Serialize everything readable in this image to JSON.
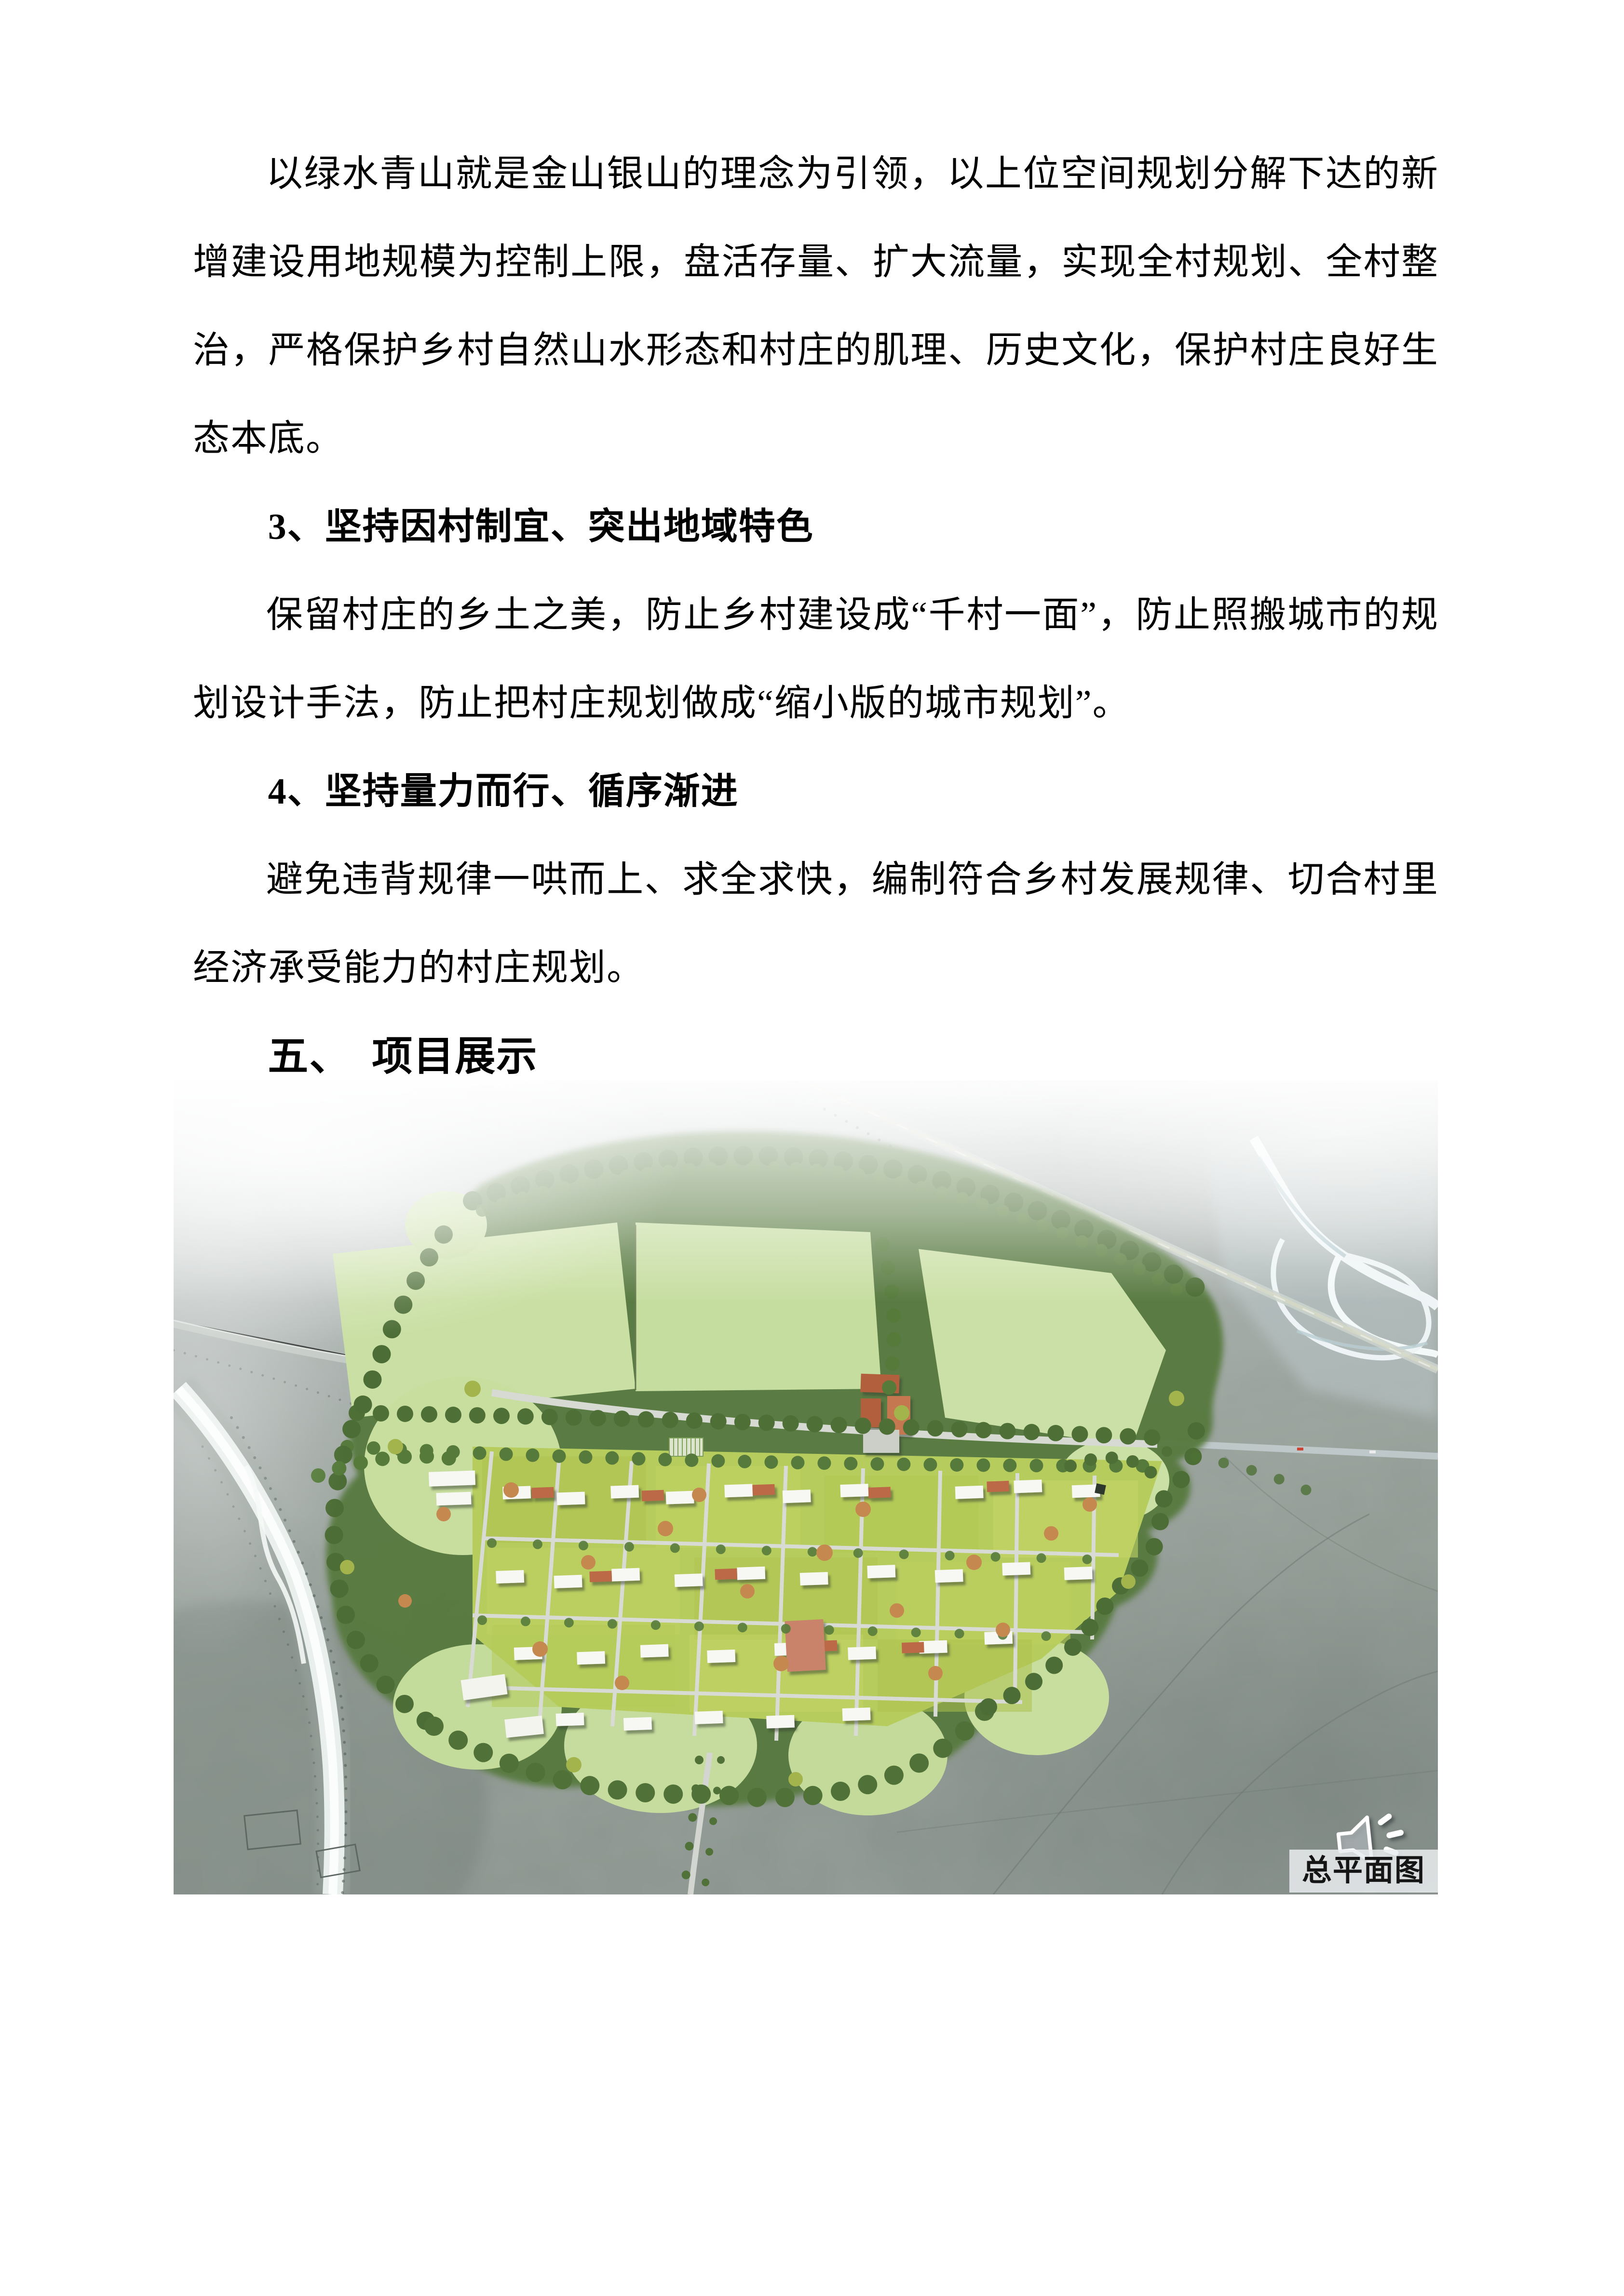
{
  "document": {
    "intro_paragraph": "以绿水青山就是金山银山的理念为引领，以上位空间规划分解下达的新增建设用地规模为控制上限，盘活存量、扩大流量，实现全村规划、全村整治，严格保护乡村自然山水形态和村庄的肌理、历史文化，保护村庄良好生态本底。",
    "principle_3_heading": "3、坚持因村制宜、突出地域特色",
    "principle_3_paragraph": "保留村庄的乡土之美，防止乡村建设成“千村一面”，防止照搬城市的规划设计手法，防止把村庄规划做成“缩小版的城市规划”。",
    "principle_4_heading": "4、坚持量力而行、循序渐进",
    "principle_4_paragraph": "避免违背规律一哄而上、求全求快，编制符合乡村发展规律、切合村里经济承受能力的村庄规划。",
    "section_5_heading": "五、　项目展示"
  },
  "figure": {
    "caption": "总平面图",
    "icons": {
      "audio": "speaker-sound-icon"
    },
    "colors": {
      "field_green": "#c9dfa3",
      "parcel_green": "#b6cc5d",
      "tree_green": "#4e7036",
      "tree_accent_orange": "#c5884f",
      "lawn_green": "#c8de9f",
      "road_gray": "#d6d9d2",
      "desert_light": "#e9eced",
      "desert_mid": "#9aa39e",
      "desert_dark": "#7f8983",
      "river_white": "#f4f8f7",
      "building_white": "#f7f7f3",
      "roof_terracotta": "#bb6946",
      "caption_bg": "#e9ecee",
      "caption_text": "#151515"
    }
  }
}
